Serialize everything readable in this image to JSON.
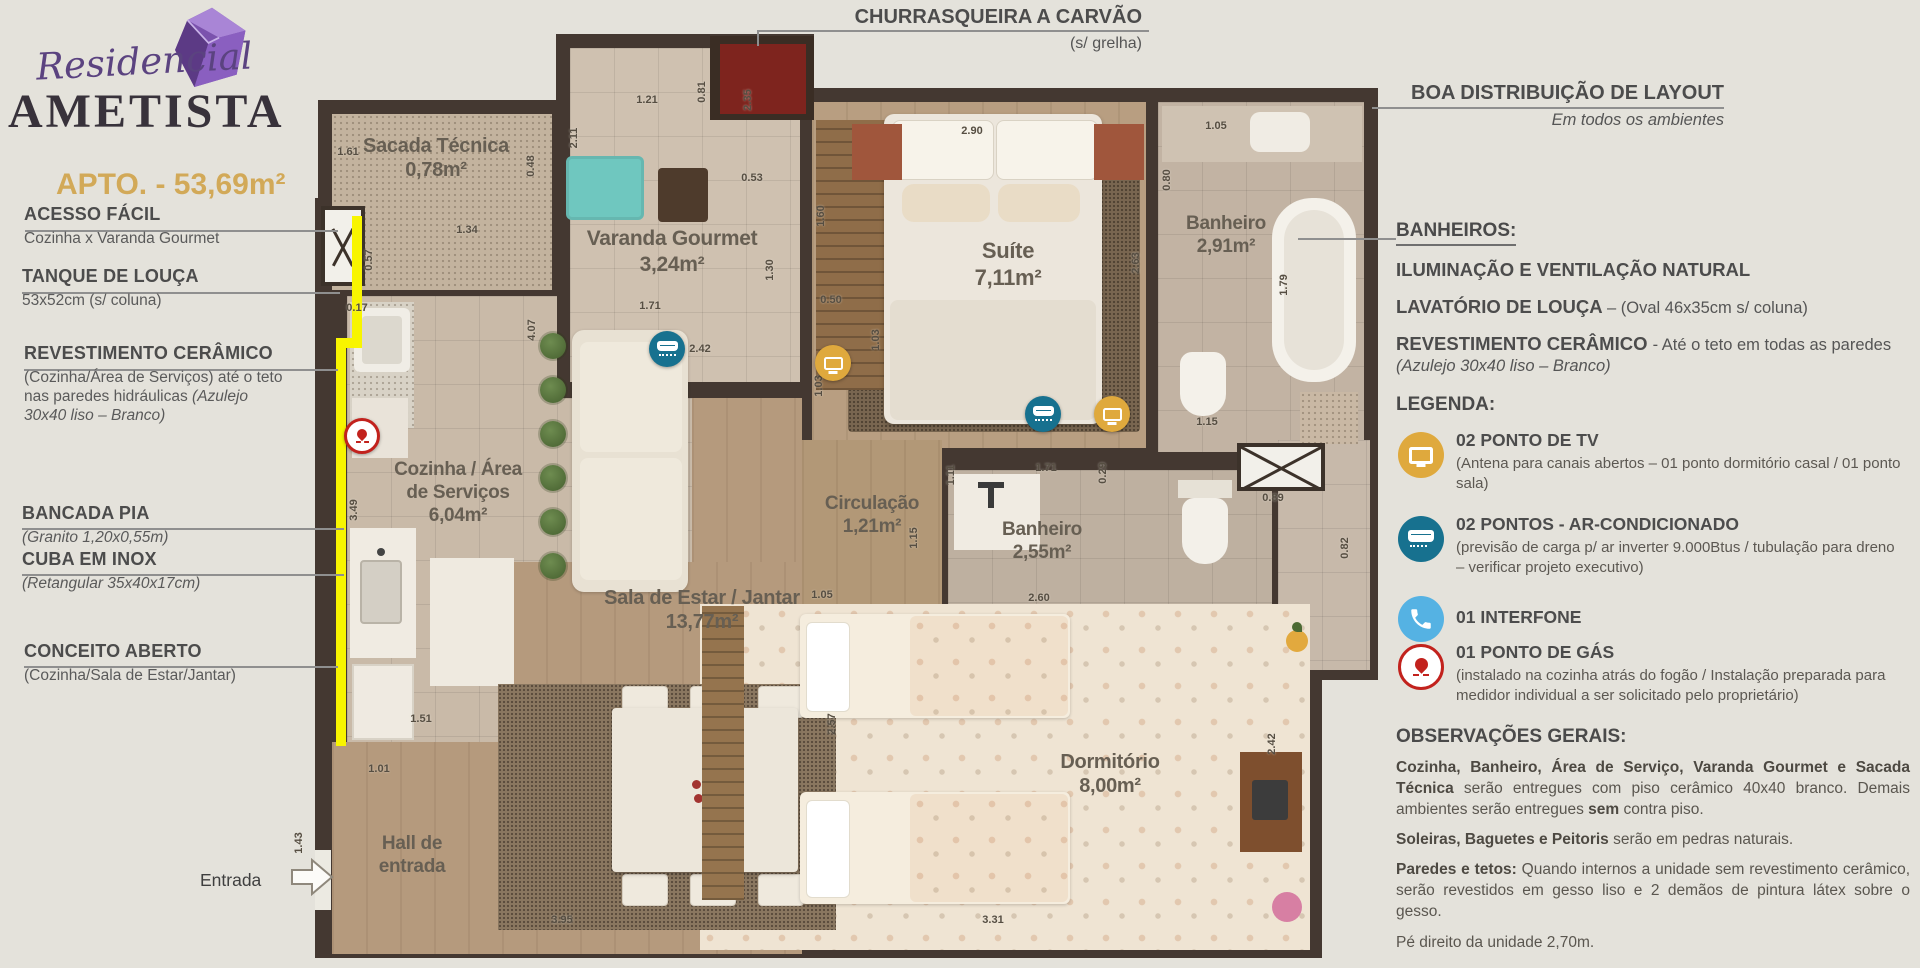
{
  "branding": {
    "script": "Residencial",
    "name": "AMETISTA",
    "apto": "APTO. - 53,69m²"
  },
  "callouts": {
    "churrasqueira": {
      "title": "CHURRASQUEIRA A CARVÃO",
      "sub": "(s/ grelha)"
    },
    "layout": {
      "title": "BOA DISTRIBUIÇÃO DE LAYOUT",
      "sub": "Em todos os ambientes"
    },
    "entrada": "Entrada"
  },
  "annotations_left": [
    {
      "title": "ACESSO FÁCIL",
      "runs": [
        [
          "Cozinha x Varanda Gourmet",
          0
        ]
      ]
    },
    {
      "title": "TANQUE DE LOUÇA",
      "runs": [
        [
          "53x52cm (s/ coluna)",
          0
        ]
      ]
    },
    {
      "title": "REVESTIMENTO CERÂMICO",
      "runs": [
        [
          "(Cozinha/Área de Serviços) até o teto nas paredes hidráulicas ",
          0
        ],
        [
          "(Azulejo 30x40 liso – Branco)",
          2
        ]
      ]
    },
    {
      "title": "BANCADA PIA",
      "runs": [
        [
          "(Granito 1,20x0,55m)",
          2
        ]
      ]
    },
    {
      "title": "CUBA EM INOX",
      "runs": [
        [
          "(Retangular 35x40x17cm)",
          2
        ]
      ]
    },
    {
      "title": "CONCEITO ABERTO",
      "runs": [
        [
          "(Cozinha/Sala de Estar/Jantar)",
          0
        ]
      ]
    }
  ],
  "banheiros": {
    "title": "BANHEIROS:",
    "line1": [
      [
        "ILUMINAÇÃO E VENTILAÇÃO NATURAL",
        1
      ]
    ],
    "line2": [
      [
        "LAVATÓRIO DE LOUÇA ",
        1
      ],
      [
        "– (Oval 46x35cm s/ coluna)",
        0
      ]
    ],
    "line3": [
      [
        "REVESTIMENTO CERÂMICO ",
        1
      ],
      [
        "- Até o teto em todas as paredes ",
        0
      ],
      [
        "(Azulejo 30x40 liso – Branco)",
        2
      ]
    ]
  },
  "legenda": {
    "title": "LEGENDA:",
    "items": [
      {
        "icon": "tv-icon",
        "title": "02 PONTO DE TV",
        "desc": "(Antena para canais abertos – 01 ponto dormitório casal / 01 ponto sala)"
      },
      {
        "icon": "ac-icon",
        "title": "02 PONTOS - AR-CONDICIONADO",
        "desc": "(previsão de carga p/ ar inverter 9.000Btus / tubulação para dreno – verificar projeto executivo)"
      },
      {
        "icon": "phone-icon",
        "title": "01 INTERFONE",
        "desc": ""
      },
      {
        "icon": "gas-icon",
        "title": "01 PONTO DE GÁS",
        "desc": "(instalado na cozinha atrás do fogão / Instalação preparada para medidor individual a ser solicitado pelo proprietário)"
      }
    ]
  },
  "observacoes": {
    "title": "OBSERVAÇÕES GERAIS:",
    "p1": [
      [
        "Cozinha, Banheiro, Área de Serviço, Varanda Gourmet e Sacada Técnica",
        1
      ],
      [
        " serão entregues com piso cerâmico 40x40 branco. Demais ambientes serão entregues ",
        0
      ],
      [
        "sem",
        1
      ],
      [
        " contra piso.",
        0
      ]
    ],
    "p2": [
      [
        "Soleiras, Baguetes e Peitoris",
        1
      ],
      [
        " serão em pedras naturais.",
        0
      ]
    ],
    "p3": [
      [
        "Paredes e tetos:",
        1
      ],
      [
        " Quando internos a unidade sem revestimento cerâmico, serão revestidos em gesso liso e 2 demãos de pintura látex sobre o gesso.",
        0
      ]
    ],
    "p4": [
      [
        "Pé direito da unidade 2,70m.",
        0
      ]
    ]
  },
  "plan": {
    "rooms": [
      {
        "lines": [
          "Sacada Técnica"
        ],
        "area": "0,78m²",
        "x": 436,
        "y": 134,
        "size": 20
      },
      {
        "lines": [
          "Varanda Gourmet"
        ],
        "area": "3,24m²",
        "x": 672,
        "y": 226,
        "size": 21
      },
      {
        "lines": [
          "Suíte"
        ],
        "area": "7,11m²",
        "x": 1008,
        "y": 238,
        "size": 22
      },
      {
        "lines": [
          "Banheiro"
        ],
        "area": "2,91m²",
        "x": 1226,
        "y": 212,
        "size": 19
      },
      {
        "lines": [
          "Cozinha / Área",
          "de Serviços"
        ],
        "area": "6,04m²",
        "x": 458,
        "y": 458,
        "size": 19
      },
      {
        "lines": [
          "Circulação"
        ],
        "area": "1,21m²",
        "x": 872,
        "y": 492,
        "size": 19
      },
      {
        "lines": [
          "Banheiro"
        ],
        "area": "2,55m²",
        "x": 1042,
        "y": 518,
        "size": 19
      },
      {
        "lines": [
          "Sala de Estar / Jantar"
        ],
        "area": "13,77m²",
        "x": 702,
        "y": 586,
        "size": 20
      },
      {
        "lines": [
          "Dormitório"
        ],
        "area": "8,00m²",
        "x": 1110,
        "y": 750,
        "size": 20
      },
      {
        "lines": [
          "Hall de",
          "entrada"
        ],
        "area": "",
        "x": 412,
        "y": 832,
        "size": 19
      }
    ],
    "dimensions": [
      {
        "t": "1.61",
        "x": 348,
        "y": 152,
        "r": 0
      },
      {
        "t": "0.48",
        "x": 531,
        "y": 166,
        "r": 1
      },
      {
        "t": "1.21",
        "x": 647,
        "y": 100,
        "r": 0
      },
      {
        "t": "2.11",
        "x": 574,
        "y": 138,
        "r": 1
      },
      {
        "t": "0.81",
        "x": 702,
        "y": 92,
        "r": 1
      },
      {
        "t": "2.35",
        "x": 748,
        "y": 100,
        "r": 1
      },
      {
        "t": "0.53",
        "x": 752,
        "y": 178,
        "r": 0
      },
      {
        "t": "1.30",
        "x": 770,
        "y": 270,
        "r": 1
      },
      {
        "t": "1.71",
        "x": 650,
        "y": 306,
        "r": 0
      },
      {
        "t": "2.42",
        "x": 700,
        "y": 349,
        "r": 0
      },
      {
        "t": "1.34",
        "x": 467,
        "y": 230,
        "r": 0
      },
      {
        "t": "0.57",
        "x": 369,
        "y": 260,
        "r": 1
      },
      {
        "t": "0.17",
        "x": 357,
        "y": 308,
        "r": 0
      },
      {
        "t": "4.07",
        "x": 532,
        "y": 330,
        "r": 1
      },
      {
        "t": "2.90",
        "x": 972,
        "y": 131,
        "r": 0
      },
      {
        "t": "1.05",
        "x": 1216,
        "y": 126,
        "r": 0
      },
      {
        "t": "0.80",
        "x": 1167,
        "y": 180,
        "r": 1
      },
      {
        "t": "1.60",
        "x": 821,
        "y": 216,
        "r": 1
      },
      {
        "t": "0.50",
        "x": 831,
        "y": 300,
        "r": 0
      },
      {
        "t": "2.63",
        "x": 1136,
        "y": 263,
        "r": 1
      },
      {
        "t": "1.79",
        "x": 1284,
        "y": 285,
        "r": 1
      },
      {
        "t": "1.03",
        "x": 876,
        "y": 340,
        "r": 1
      },
      {
        "t": "1.03",
        "x": 819,
        "y": 386,
        "r": 1
      },
      {
        "t": "2.40",
        "x": 1046,
        "y": 418,
        "r": 0
      },
      {
        "t": "1.15",
        "x": 1207,
        "y": 422,
        "r": 0
      },
      {
        "t": "1.11",
        "x": 951,
        "y": 475,
        "r": 1
      },
      {
        "t": "1.71",
        "x": 1046,
        "y": 468,
        "r": 0
      },
      {
        "t": "0.29",
        "x": 1103,
        "y": 473,
        "r": 1
      },
      {
        "t": "0.89",
        "x": 1273,
        "y": 498,
        "r": 0
      },
      {
        "t": "0.82",
        "x": 1345,
        "y": 548,
        "r": 1
      },
      {
        "t": "1.15",
        "x": 914,
        "y": 538,
        "r": 1
      },
      {
        "t": "1.05",
        "x": 822,
        "y": 595,
        "r": 0
      },
      {
        "t": "2.60",
        "x": 1039,
        "y": 598,
        "r": 0
      },
      {
        "t": "2.57",
        "x": 832,
        "y": 724,
        "r": 1
      },
      {
        "t": "2.42",
        "x": 1272,
        "y": 744,
        "r": 1
      },
      {
        "t": "3.95",
        "x": 562,
        "y": 920,
        "r": 0
      },
      {
        "t": "3.31",
        "x": 993,
        "y": 920,
        "r": 0
      },
      {
        "t": "3.49",
        "x": 354,
        "y": 510,
        "r": 1
      },
      {
        "t": "1.51",
        "x": 421,
        "y": 719,
        "r": 0
      },
      {
        "t": "1.01",
        "x": 379,
        "y": 769,
        "r": 0
      },
      {
        "t": "1.43",
        "x": 299,
        "y": 843,
        "r": 1
      }
    ],
    "icons": [
      {
        "type": "ac",
        "x": 667,
        "y": 349
      },
      {
        "type": "tv",
        "x": 833,
        "y": 363
      },
      {
        "type": "ac",
        "x": 1043,
        "y": 414
      },
      {
        "type": "tv",
        "x": 1112,
        "y": 414
      },
      {
        "type": "gas",
        "x": 362,
        "y": 436
      }
    ]
  }
}
